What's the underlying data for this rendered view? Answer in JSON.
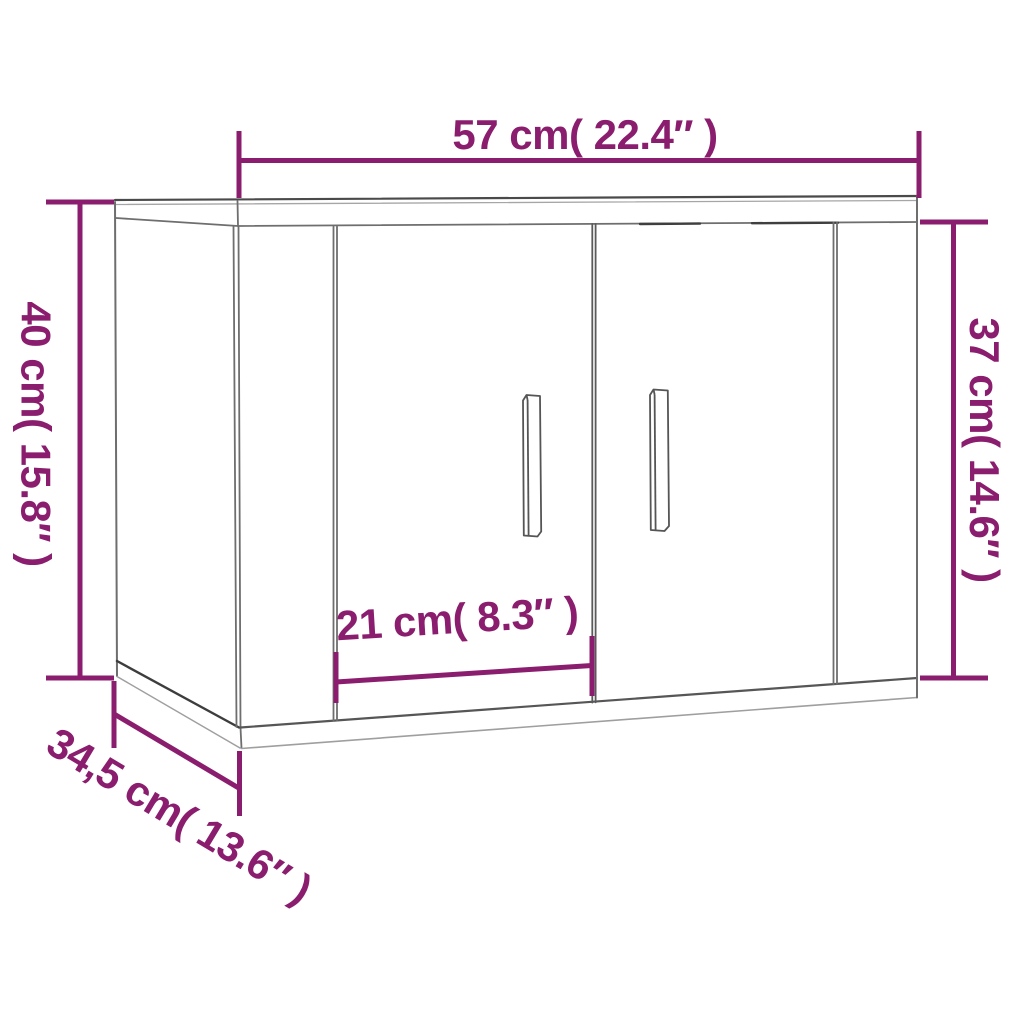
{
  "diagram": {
    "title": "wall-mounted-cabinet-dimension-diagram",
    "product": "two-door wall cabinet line drawing"
  },
  "dimensions": {
    "width_top": {
      "label": "57 cm( 22.4″ )",
      "cm": 57,
      "inches": 22.4
    },
    "height_total_left": {
      "label": "40 cm( 15.8″ )",
      "cm": 40,
      "inches": 15.8
    },
    "height_front_right": {
      "label": "37 cm( 14.6″ )",
      "cm": 37,
      "inches": 14.6
    },
    "door_width_inner": {
      "label": "21 cm( 8.3″ )",
      "cm": 21,
      "inches": 8.3
    },
    "depth_bottom_left": {
      "label": "34,5 cm( 13.6″ )",
      "cm": "34,5",
      "inches": 13.6
    }
  },
  "colors": {
    "dimension": "#8a1d6e",
    "outline": "#6e6e6e",
    "background": "#ffffff"
  }
}
